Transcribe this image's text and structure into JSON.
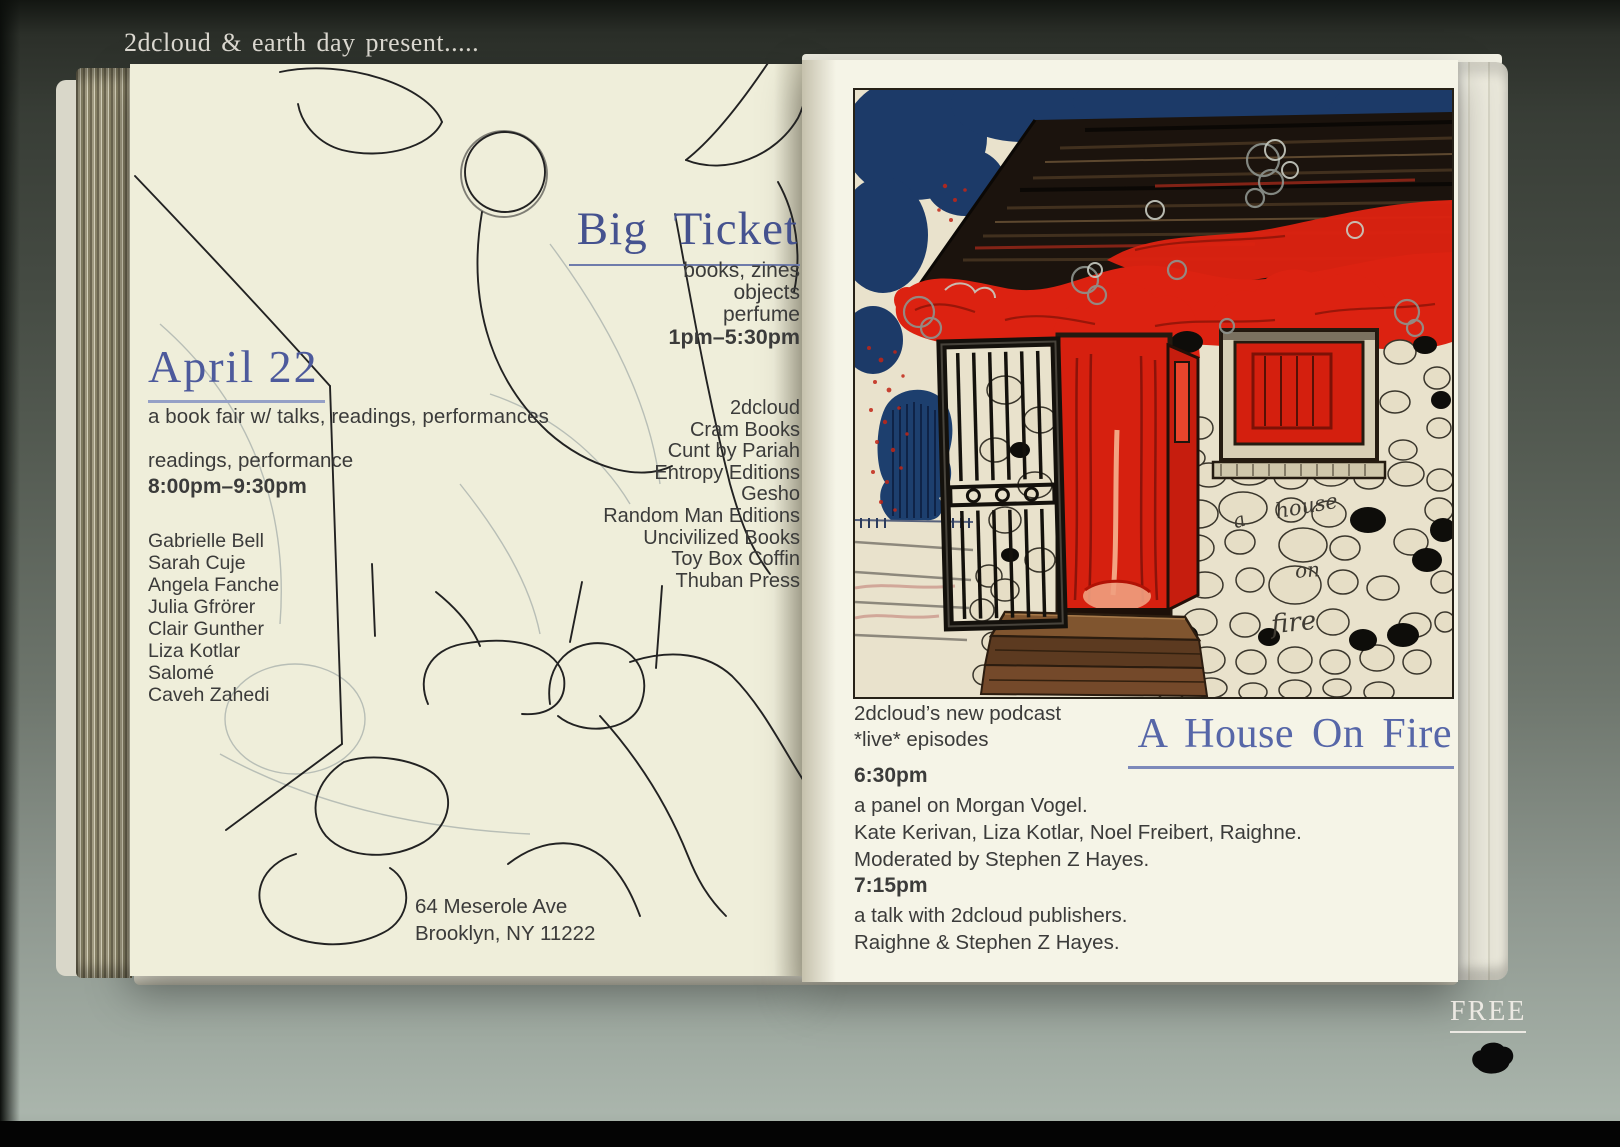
{
  "colors": {
    "background": "#5a635c",
    "page_cream": "#efeeda",
    "page_white": "#f5f4e7",
    "heading_blue": "#4d5a9c",
    "text_dark": "#3b3b3a",
    "flame_red": "#dc2211",
    "sky_navy": "#1c3a68",
    "free_white": "#ece9e3"
  },
  "header": {
    "presents_line": "2dcloud & earth day present....."
  },
  "left_page": {
    "event": {
      "date_heading": "April 22",
      "subtitle": "a book fair w/ talks, readings, performances",
      "readings_label": "readings, performance",
      "readings_time": "8:00pm–9:30pm",
      "participants": [
        "Gabrielle Bell",
        "Sarah Cuje",
        "Angela Fanche",
        "Julia Gfrörer",
        "Clair Gunther",
        "Liza Kotlar",
        "Salomé",
        "Caveh Zahedi"
      ],
      "address": {
        "line1": "64 Meserole Ave",
        "line2": "Brooklyn, NY 11222"
      }
    },
    "fair": {
      "heading": "Big Ticket",
      "offerings": [
        "books, zines",
        "objects",
        "perfume"
      ],
      "time": "1pm–5:30pm",
      "exhibitors": [
        "2dcloud",
        "Cram Books",
        "Cunt by Pariah",
        "Entropy Editions",
        "Gesho",
        "Random Man Editions",
        "Uncivilized Books",
        "Toy Box Coffin",
        "Thuban Press"
      ]
    }
  },
  "right_page": {
    "illustration": {
      "caption_words": [
        "a",
        "house",
        "on",
        "fire"
      ]
    },
    "podcast": {
      "intro_line1": "2dcloud’s new podcast",
      "intro_line2": "*live* episodes",
      "heading": "A House On Fire",
      "sessions": [
        {
          "time": "6:30pm",
          "lines": [
            "a panel on Morgan Vogel.",
            "Kate Kerivan, Liza Kotlar, Noel Freibert, Raighne.",
            "Moderated by Stephen Z Hayes."
          ]
        },
        {
          "time": "7:15pm",
          "lines": [
            "a talk with 2dcloud publishers.",
            "Raighne & Stephen Z Hayes."
          ]
        }
      ]
    }
  },
  "footer": {
    "free_label": "FREE",
    "logo_icon": "cloud-blob"
  }
}
